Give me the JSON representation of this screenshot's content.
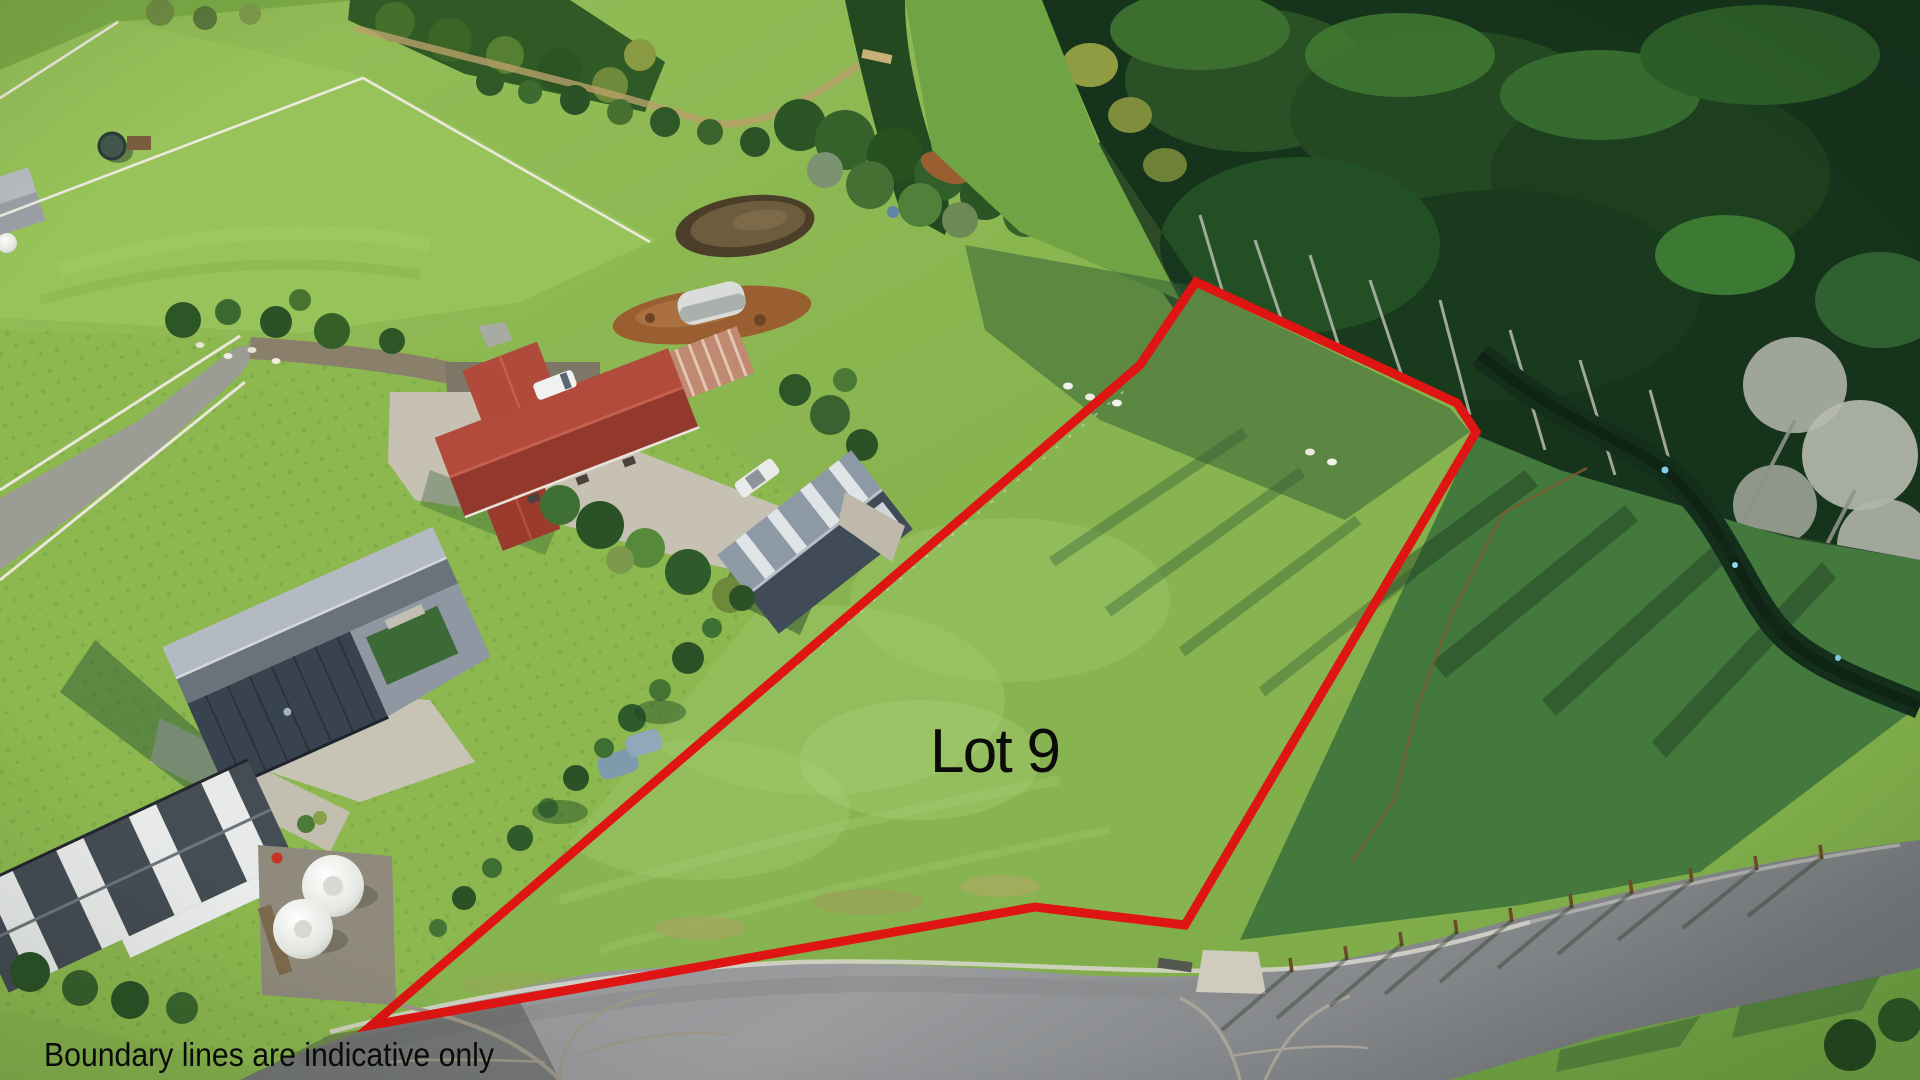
{
  "overlay": {
    "lot_label": "Lot 9",
    "disclaimer": "Boundary lines are indicative only",
    "text_color": "#0b0b0b"
  },
  "boundary": {
    "points": "372,1025 1140,365 1196,282 1457,403 1476,432 1185,925 1035,907",
    "color": "#de1512",
    "stroke_width": "9"
  }
}
